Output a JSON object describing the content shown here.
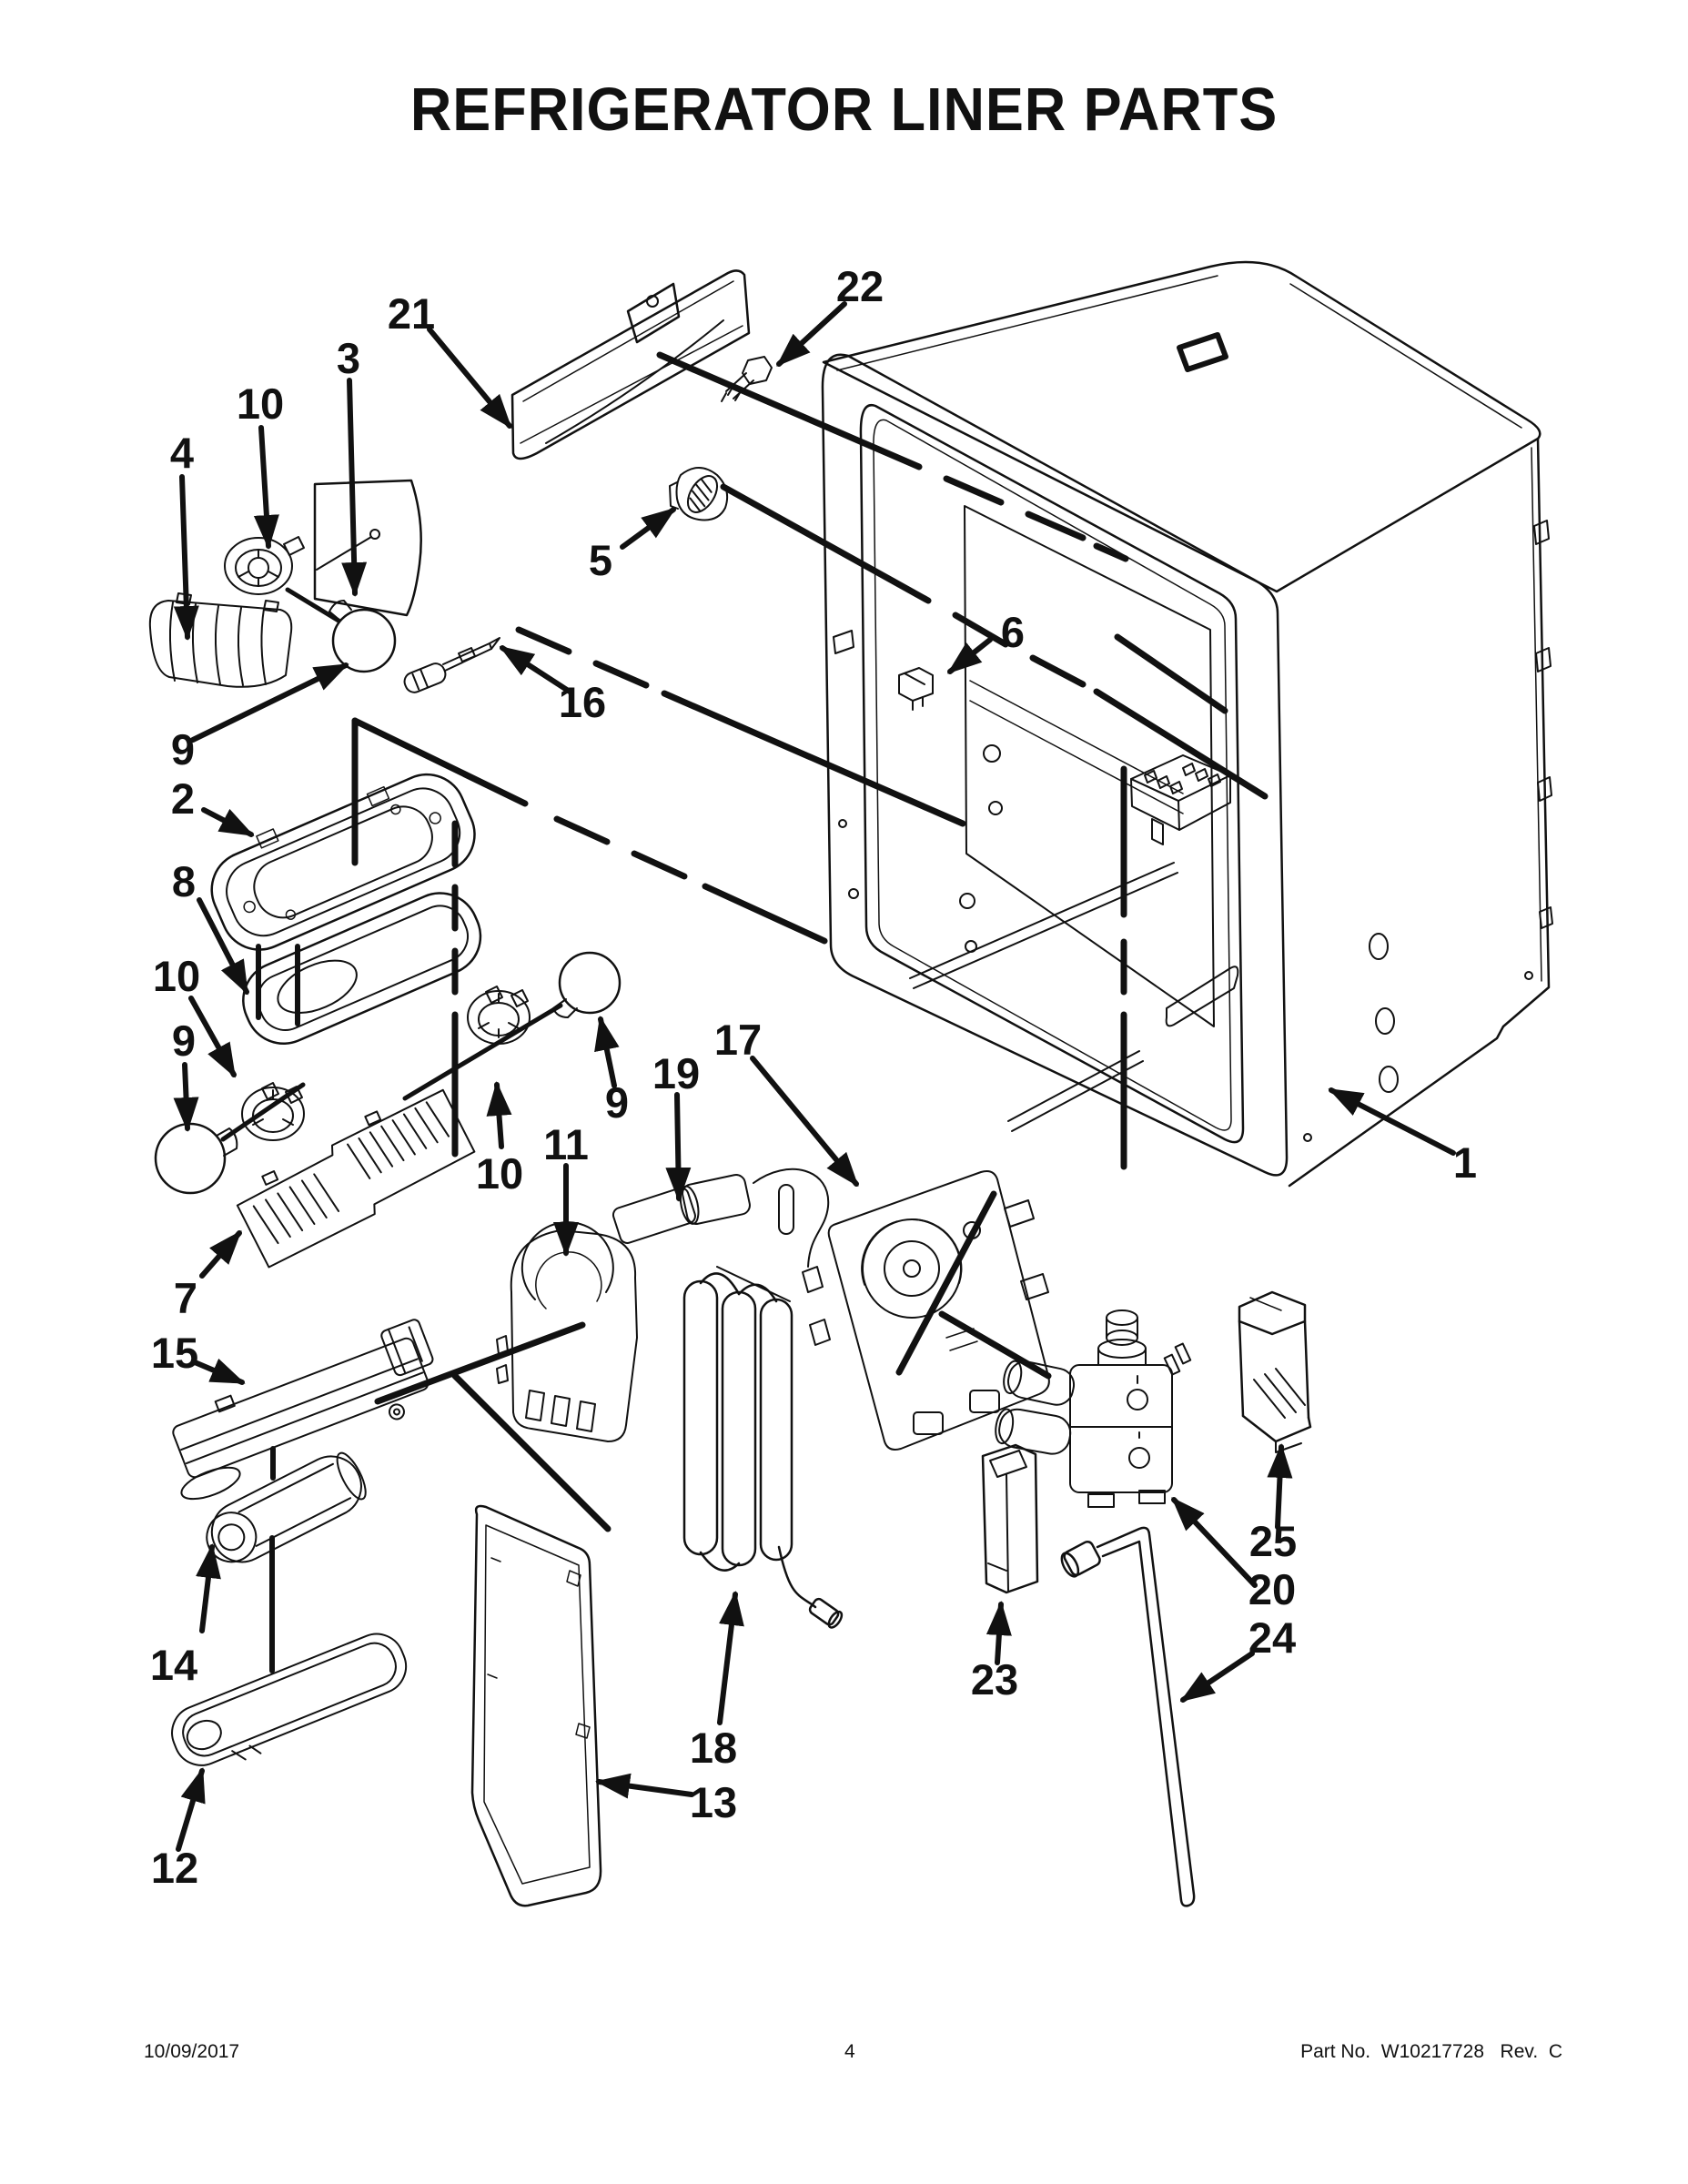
{
  "page": {
    "title": "REFRIGERATOR LINER PARTS",
    "footer": {
      "date": "10/09/2017",
      "page_number": "4",
      "part_no": "Part No.  W10217728   Rev.  C"
    }
  },
  "colors": {
    "ink": "#111111",
    "paper": "#ffffff"
  },
  "callouts": [
    "21",
    "22",
    "3",
    "10",
    "4",
    "5",
    "6",
    "16",
    "9",
    "2",
    "8",
    "10",
    "9",
    "7",
    "15",
    "10",
    "11",
    "9",
    "19",
    "17",
    "1",
    "14",
    "12",
    "18",
    "13",
    "23",
    "25",
    "20",
    "24"
  ]
}
